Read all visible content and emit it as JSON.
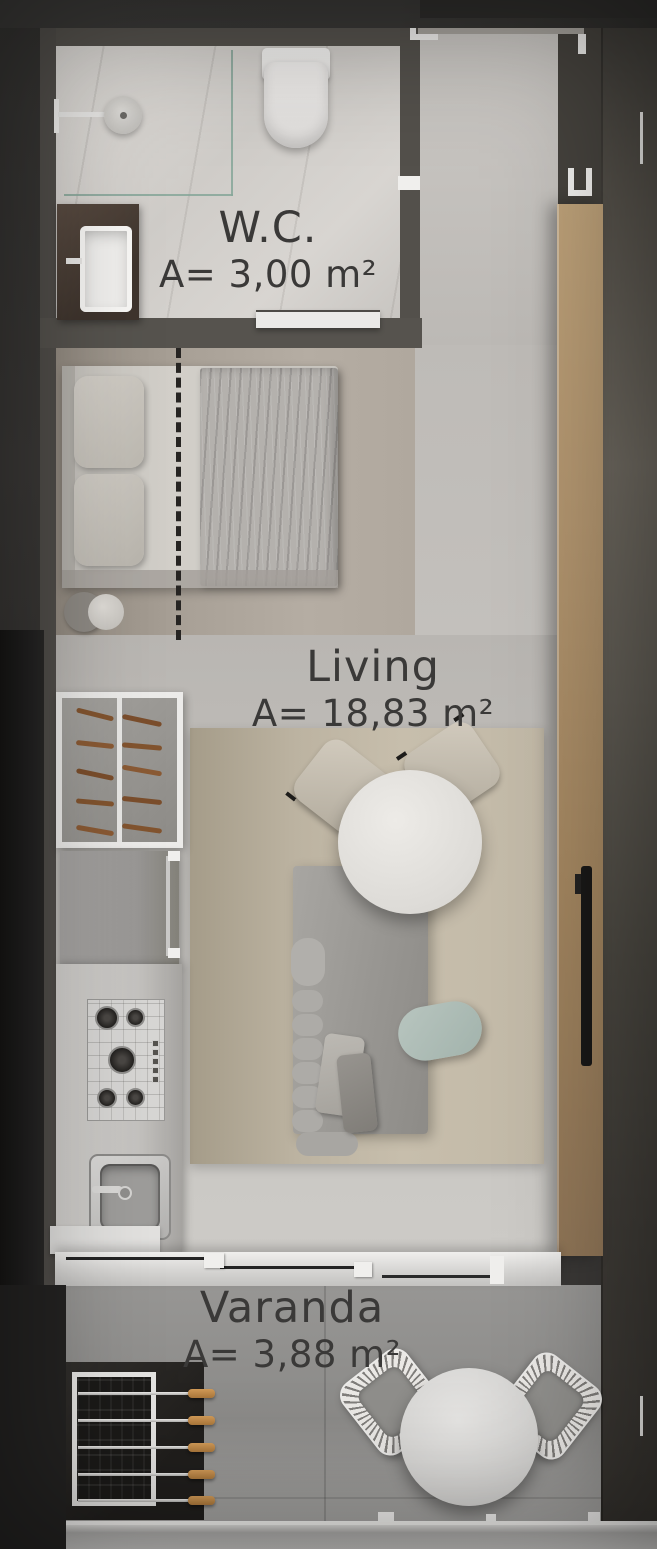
{
  "rooms": {
    "wc": {
      "name": "W.C.",
      "area": "A= 3,00 m²"
    },
    "living": {
      "name": "Living",
      "area": "A= 18,83 m²"
    },
    "varanda": {
      "name": "Varanda",
      "area": "A= 3,88 m²"
    }
  },
  "colors": {
    "wall_dark": "#55524e",
    "floor_concrete": "#c4c1bd",
    "floor_marble": "#d6d3cf",
    "floor_bedroom": "#aaa298",
    "floor_varanda": "#8e8d8b",
    "rug_beige": "#c2b9a9",
    "wood_pivot_door": "#ab8f6e",
    "side_table_sage": "#aebcb6",
    "glass_partition_teal": "#86a699",
    "label_text": "#3a3938"
  },
  "furniture": {
    "bathroom": [
      "shower-head",
      "shower-glass-partition",
      "toilet",
      "vanity-counter",
      "washbasin",
      "door-leaf"
    ],
    "bedroom": [
      "double-bed",
      "pillows",
      "duvet",
      "nightstand",
      "dashed-partition-line"
    ],
    "kitchen": [
      "hanger-closet",
      "refrigerator",
      "cooktop-5-burner",
      "kitchen-sink"
    ],
    "living": [
      "area-rug",
      "round-dining-table",
      "dining-chairs",
      "sofa",
      "sofa-cushions",
      "side-table",
      "wall-tv"
    ],
    "entry": [
      "door-frame",
      "wood-pivot-door-panel"
    ],
    "varanda": [
      "sliding-glass-door",
      "bbq-grill",
      "grill-skewers",
      "outdoor-round-table",
      "wicker-chairs",
      "glass-railing"
    ]
  }
}
